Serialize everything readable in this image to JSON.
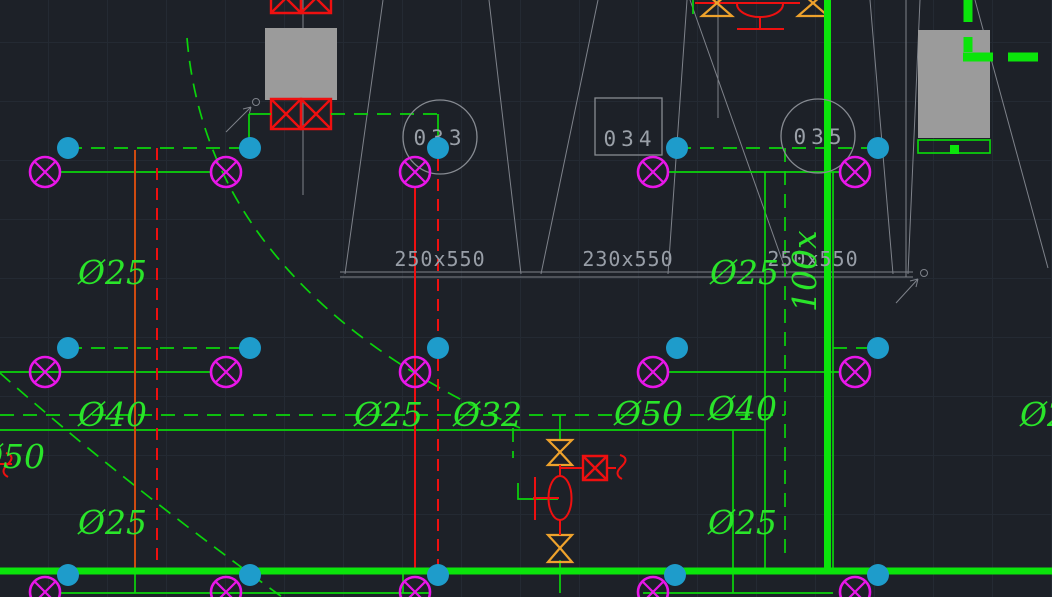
{
  "drawing": {
    "colors": {
      "background": "#1d2128",
      "grid": "#242a33",
      "pipe_green": "#0bd40b",
      "main_green": "#0be40b",
      "label_green": "#2ae42a",
      "lamp_magenta": "#e816e8",
      "junction_cyan": "#1e9ccb",
      "pipe_red": "#ee1010",
      "riser_orange_red": "#cf4b10",
      "valve_orange": "#eea22c",
      "structure_gray": "#878b92",
      "text_gray": "#9aa0a8",
      "fill_gray": "#9b9b9b"
    },
    "room_tags": [
      {
        "label": "033",
        "shape": "circle"
      },
      {
        "label": "034",
        "shape": "rect"
      },
      {
        "label": "035",
        "shape": "circle"
      }
    ],
    "duct_size_labels": [
      {
        "text": "250x550",
        "cx": 440,
        "y": 266
      },
      {
        "text": "230x550",
        "cx": 628,
        "y": 266
      },
      {
        "text": "250x550",
        "cx": 813,
        "y": 266
      }
    ],
    "vertical_duct_label": {
      "text": "100x",
      "x": 816,
      "y": 312,
      "rotate": -90
    },
    "pipe_diameter_labels": [
      {
        "text": "Ø25",
        "x": 78,
        "y": 284
      },
      {
        "text": "Ø25",
        "x": 710,
        "y": 284
      },
      {
        "text": "Ø40",
        "x": 78,
        "y": 426
      },
      {
        "text": "Ø25",
        "x": 354,
        "y": 426
      },
      {
        "text": "Ø32",
        "x": 453,
        "y": 426
      },
      {
        "text": "Ø50",
        "x": 614,
        "y": 425
      },
      {
        "text": "Ø40",
        "x": 708,
        "y": 420
      },
      {
        "text": "Ø25",
        "x": 1020,
        "y": 426
      },
      {
        "text": "Ø50",
        "x": -24,
        "y": 468
      },
      {
        "text": "Ø25",
        "x": 78,
        "y": 534
      },
      {
        "text": "Ø25",
        "x": 708,
        "y": 534
      }
    ],
    "junction_dots": [
      [
        68,
        148
      ],
      [
        250,
        148
      ],
      [
        438,
        148
      ],
      [
        677,
        148
      ],
      [
        878,
        148
      ],
      [
        68,
        348
      ],
      [
        250,
        348
      ],
      [
        438,
        348
      ],
      [
        677,
        348
      ],
      [
        878,
        348
      ],
      [
        68,
        575
      ],
      [
        250,
        575
      ],
      [
        438,
        575
      ],
      [
        675,
        575
      ],
      [
        878,
        575
      ]
    ],
    "lamp_symbols": [
      [
        45,
        172
      ],
      [
        226,
        172
      ],
      [
        415,
        172
      ],
      [
        653,
        172
      ],
      [
        855,
        172
      ],
      [
        45,
        372
      ],
      [
        226,
        372
      ],
      [
        415,
        372
      ],
      [
        653,
        372
      ],
      [
        855,
        372
      ],
      [
        45,
        592
      ],
      [
        226,
        592
      ],
      [
        415,
        592
      ],
      [
        653,
        592
      ],
      [
        855,
        592
      ]
    ]
  }
}
